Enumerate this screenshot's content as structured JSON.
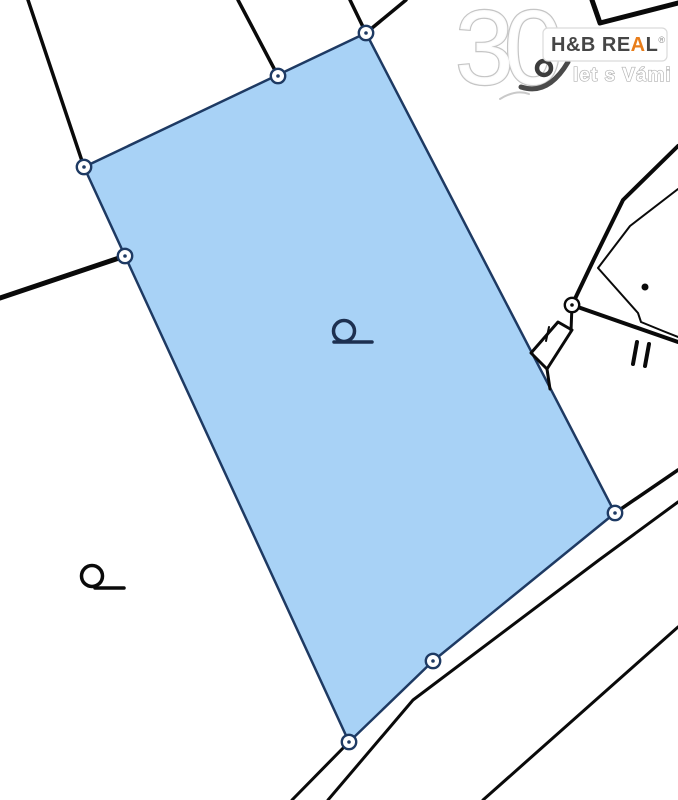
{
  "map": {
    "background": "#ffffff",
    "line_color": "#0a0a0a",
    "parcel_fill": "#a8d2f6",
    "parcel_stroke": "#1e3a63",
    "marker_ring": "#1e3a63",
    "junction_ring": "#0a0a0a",
    "shapes": [
      {
        "kind": "polygon",
        "name": "highlighted-parcel",
        "points": [
          [
            366,
            33
          ],
          [
            615,
            513
          ],
          [
            433,
            661
          ],
          [
            349,
            742
          ],
          [
            84,
            167
          ]
        ],
        "fill": "#a8d2f6",
        "stroke": "#1e3a63",
        "width": 2.5
      },
      {
        "kind": "polyline",
        "name": "boundary-top-left",
        "points": [
          [
            28,
            0
          ],
          [
            84,
            167
          ]
        ],
        "width": 3.5
      },
      {
        "kind": "polyline",
        "name": "boundary-top-mid",
        "points": [
          [
            238,
            0
          ],
          [
            278,
            76
          ]
        ],
        "width": 3.5
      },
      {
        "kind": "polyline",
        "name": "boundary-top-v1",
        "points": [
          [
            350,
            0
          ],
          [
            366,
            33
          ]
        ],
        "width": 3.5
      },
      {
        "kind": "polyline",
        "name": "boundary-top-v2",
        "points": [
          [
            406,
            0
          ],
          [
            366,
            33
          ]
        ],
        "width": 3.5
      },
      {
        "kind": "polyline",
        "name": "boundary-left",
        "points": [
          [
            0,
            298
          ],
          [
            125,
            256
          ]
        ],
        "width": 5
      },
      {
        "kind": "polyline",
        "name": "corner-top-right",
        "points": [
          [
            592,
            0
          ],
          [
            600,
            23
          ],
          [
            678,
            3
          ]
        ],
        "width": 5
      },
      {
        "kind": "polyline",
        "name": "junction-line-upper",
        "points": [
          [
            572,
            305
          ],
          [
            594,
            259
          ],
          [
            623,
            200
          ],
          [
            678,
            146
          ]
        ],
        "width": 4
      },
      {
        "kind": "polyline",
        "name": "junction-line-lower-right",
        "points": [
          [
            572,
            305
          ],
          [
            678,
            342
          ]
        ],
        "width": 4
      },
      {
        "kind": "polyline",
        "name": "junction-stub",
        "points": [
          [
            572,
            305
          ],
          [
            571,
            331
          ]
        ],
        "width": 3
      },
      {
        "kind": "polygon",
        "name": "small-parcel",
        "points": [
          [
            558,
            322
          ],
          [
            572,
            330
          ],
          [
            547,
            369
          ],
          [
            531,
            353
          ]
        ],
        "fill": "none",
        "stroke": "#0a0a0a",
        "width": 3
      },
      {
        "kind": "polyline",
        "name": "small-parcel-extension",
        "points": [
          [
            547,
            369
          ],
          [
            550,
            389
          ]
        ],
        "width": 3
      },
      {
        "kind": "polyline",
        "name": "small-parcel-tick",
        "points": [
          [
            549,
            327
          ],
          [
            546,
            341
          ]
        ],
        "width": 2
      },
      {
        "kind": "polyline",
        "name": "boundary-east-corner",
        "points": [
          [
            615,
            513
          ],
          [
            678,
            470
          ]
        ],
        "width": 3.5
      },
      {
        "kind": "polyline",
        "name": "road-edge-1",
        "points": [
          [
            678,
            502
          ],
          [
            599,
            560
          ],
          [
            413,
            700
          ],
          [
            328,
            800
          ]
        ],
        "width": 3
      },
      {
        "kind": "polyline",
        "name": "road-edge-2",
        "points": [
          [
            678,
            627
          ],
          [
            483,
            800
          ]
        ],
        "width": 3
      },
      {
        "kind": "polyline",
        "name": "boundary-south-extension",
        "points": [
          [
            349,
            742
          ],
          [
            292,
            800
          ]
        ],
        "width": 3
      },
      {
        "kind": "polyline",
        "name": "building-outline",
        "points": [
          [
            678,
            189
          ],
          [
            630,
            226
          ],
          [
            598,
            268
          ],
          [
            638,
            313
          ],
          [
            641,
            322
          ],
          [
            663,
            331
          ],
          [
            678,
            337
          ]
        ],
        "width": 2
      },
      {
        "kind": "circle",
        "name": "building-dot",
        "cx": 645,
        "cy": 287,
        "r": 3.5,
        "fill": "#0a0a0a"
      },
      {
        "kind": "polyline",
        "name": "parallel-marker-line-1",
        "points": [
          [
            637,
            342
          ],
          [
            633,
            364
          ]
        ],
        "width": 4
      },
      {
        "kind": "polyline",
        "name": "parallel-marker-line-2",
        "points": [
          [
            649,
            344
          ],
          [
            645,
            366
          ]
        ],
        "width": 4
      },
      {
        "kind": "symbol",
        "name": "land-use-symbol-parcel",
        "cx": 344,
        "cy": 331,
        "r": 10.5,
        "tail": [
          334,
          342,
          372,
          342
        ],
        "color": "#1d3050",
        "width": 3.5
      },
      {
        "kind": "symbol",
        "name": "land-use-symbol-neighbor",
        "cx": 92,
        "cy": 576,
        "r": 10.5,
        "tail": [
          95,
          588,
          124,
          588
        ],
        "color": "#0a0a0a",
        "width": 3.5
      },
      {
        "kind": "marker",
        "name": "vertex-marker-top",
        "cx": 366,
        "cy": 33,
        "ring": "#1e3a63"
      },
      {
        "kind": "marker",
        "name": "vertex-marker-top-edge",
        "cx": 278,
        "cy": 76,
        "ring": "#1e3a63"
      },
      {
        "kind": "marker",
        "name": "vertex-marker-left-corner",
        "cx": 84,
        "cy": 167,
        "ring": "#1e3a63"
      },
      {
        "kind": "marker",
        "name": "vertex-marker-left-edge",
        "cx": 125,
        "cy": 256,
        "ring": "#1e3a63"
      },
      {
        "kind": "marker",
        "name": "vertex-marker-east-corner",
        "cx": 615,
        "cy": 513,
        "ring": "#1e3a63"
      },
      {
        "kind": "marker",
        "name": "vertex-marker-bottom-edge",
        "cx": 433,
        "cy": 661,
        "ring": "#1e3a63"
      },
      {
        "kind": "marker",
        "name": "vertex-marker-bottom-corner",
        "cx": 349,
        "cy": 742,
        "ring": "#1e3a63"
      },
      {
        "kind": "marker",
        "name": "junction-marker",
        "cx": 572,
        "cy": 305,
        "ring": "#0a0a0a"
      }
    ]
  },
  "watermark": {
    "big_text": "30",
    "brand_prefix": "H&B RE",
    "brand_accent": "A",
    "brand_suffix": "L",
    "registered": "®",
    "tagline": "let s Vámi",
    "accent_color": "#e87d1a"
  }
}
